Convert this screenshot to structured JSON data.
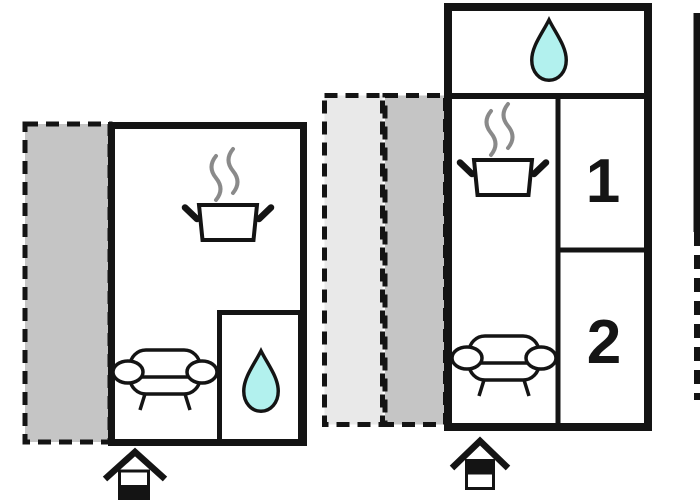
{
  "colors": {
    "wall": "#141414",
    "terrace_gray": "#c5c5c5",
    "terrace_light": "#e9e9e9",
    "water": "#b2f1ee",
    "steam": "#8a8a8a",
    "room_fill": "#ffffff",
    "background": "#ffffff"
  },
  "labels": {
    "room_1": "1",
    "room_2": "2"
  },
  "units": [
    {
      "name": "unit-left",
      "floor_indicator": "lower-level-filled"
    },
    {
      "name": "unit-right",
      "floor_indicator": "upper-level-filled"
    }
  ],
  "icons": [
    {
      "name": "cooking-pot-icon"
    },
    {
      "name": "steam-icon"
    },
    {
      "name": "sofa-icon"
    },
    {
      "name": "water-drop-icon"
    },
    {
      "name": "house-level-icon"
    }
  ]
}
